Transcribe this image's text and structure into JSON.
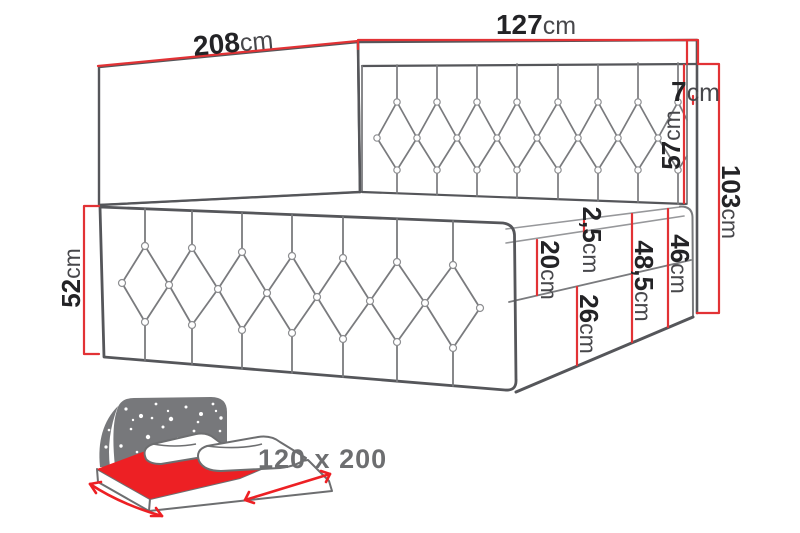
{
  "diagram": {
    "title": "Continental bed dimension drawing",
    "dimensions": {
      "length_total": {
        "value": "208",
        "unit": "cm"
      },
      "width_total": {
        "value": "127",
        "unit": "cm"
      },
      "headboard_top": {
        "value": "7",
        "unit": "cm"
      },
      "headboard_panel": {
        "value": "57",
        "unit": "cm"
      },
      "height_total": {
        "value": "103",
        "unit": "cm"
      },
      "side_front": {
        "value": "52",
        "unit": "cm"
      },
      "topper": {
        "value": "2,5",
        "unit": "cm"
      },
      "mattress_band": {
        "value": "20",
        "unit": "cm"
      },
      "base_band": {
        "value": "26",
        "unit": "cm"
      },
      "base_total": {
        "value": "48,5",
        "unit": "cm"
      },
      "side_right": {
        "value": "46",
        "unit": "cm"
      }
    },
    "size_label": "120 x 200",
    "colors": {
      "dimension_red": "#e23235",
      "icon_red": "#ed2024",
      "drawing_dark": "#55565a",
      "drawing_mid": "#7a7b7e",
      "drawing_light": "#97989b",
      "icon_gray": "#77787b",
      "size_text_gray": "#6d6e70"
    }
  }
}
